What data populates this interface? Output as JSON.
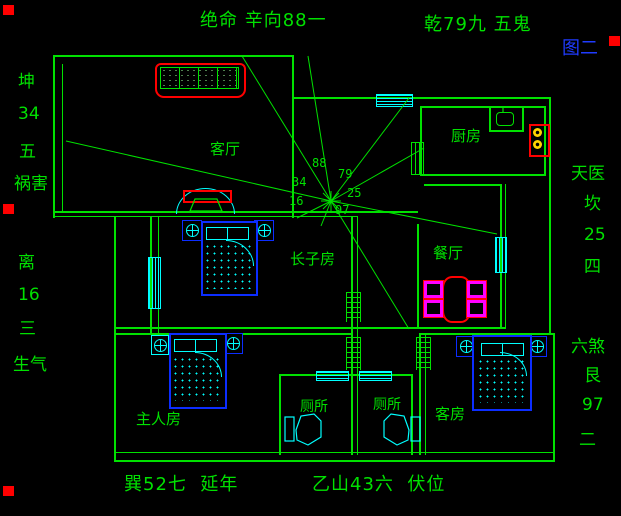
{
  "figure_label": "图二",
  "compass": {
    "top_left": "绝命 辛向88一",
    "top_right": "乾79九 五鬼",
    "left": [
      "坤",
      "34",
      "五",
      "祸害",
      "离",
      "16",
      "三",
      "生气"
    ],
    "right": [
      "天医",
      "坎",
      "25",
      "四",
      "六煞",
      "艮",
      "97",
      "二"
    ],
    "bottom_left": "巽52七  延年",
    "bottom_center": "乙山43六  伏位"
  },
  "rooms": {
    "living": "客厅",
    "kitchen": "厨房",
    "dining": "餐厅",
    "eldest_son": "长子房",
    "master": "主人房",
    "toilet_left": "厕所",
    "toilet_right": "厕所",
    "guest": "客房"
  },
  "center_numbers": {
    "n88": "88",
    "n79": "79",
    "n34": "34",
    "n25": "25",
    "n16": "16",
    "n97": "97"
  },
  "colors": {
    "green": "#00e100",
    "cyan": "#00ffff",
    "blue": "#0c2dff",
    "red": "#ff0000",
    "magenta": "#ff00ff",
    "yellow": "#ffd400",
    "figure_blue": "#1f3bff"
  }
}
